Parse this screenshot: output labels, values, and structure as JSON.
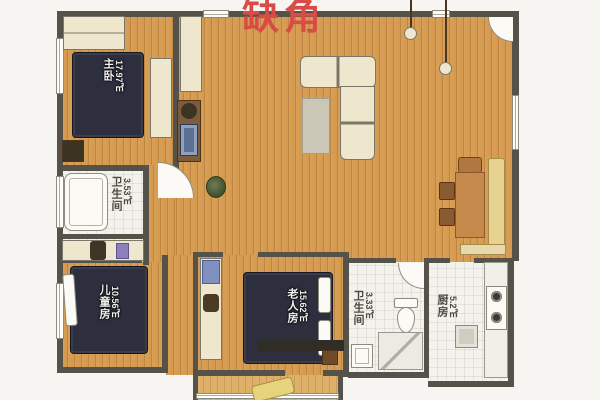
{
  "annotation": {
    "title": "缺角"
  },
  "rooms": {
    "master": {
      "name": "主卧",
      "area": "17.97㎡"
    },
    "bath_left": {
      "name": "卫生间",
      "area": "3.53㎡"
    },
    "kids": {
      "name": "儿童房",
      "area": "10.56㎡"
    },
    "elder": {
      "name": "老人房",
      "area": "15.62㎡"
    },
    "bath_right": {
      "name": "卫生间",
      "area": "3.33㎡"
    },
    "kitchen": {
      "name": "厨房",
      "area": "5.2㎡"
    }
  },
  "colors": {
    "annotation_red": "#d94b47",
    "wall": "#55524a",
    "wood_floor": "#d59a4e",
    "tile_floor": "#f3f2ec",
    "bed_navy": "#2d2f3e"
  }
}
